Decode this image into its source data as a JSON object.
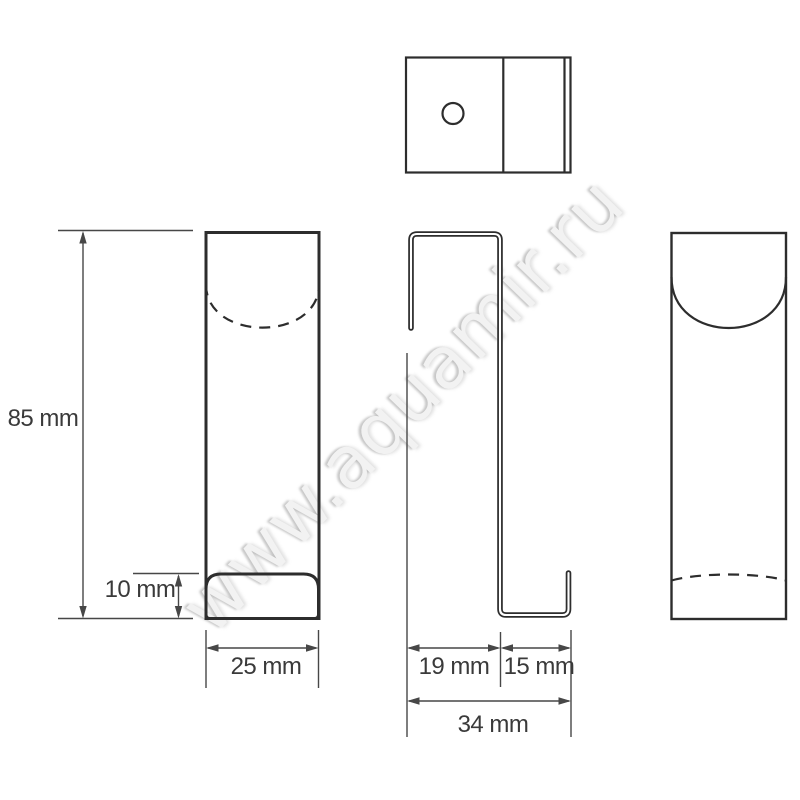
{
  "watermark": "www.aquamir.ru",
  "labels": {
    "height": "85 mm",
    "lip_height": "10 mm",
    "width": "25 mm",
    "hook_gap": "19 mm",
    "hook_return": "15 mm",
    "total_depth": "34 mm"
  },
  "colors": {
    "outline": "#2d2d2d",
    "dimension_line": "#474747",
    "label_text": "#3a3a3a",
    "watermark": "#f2f2f2",
    "watermark_shadow": "#9a9a9a",
    "background": "#ffffff"
  }
}
